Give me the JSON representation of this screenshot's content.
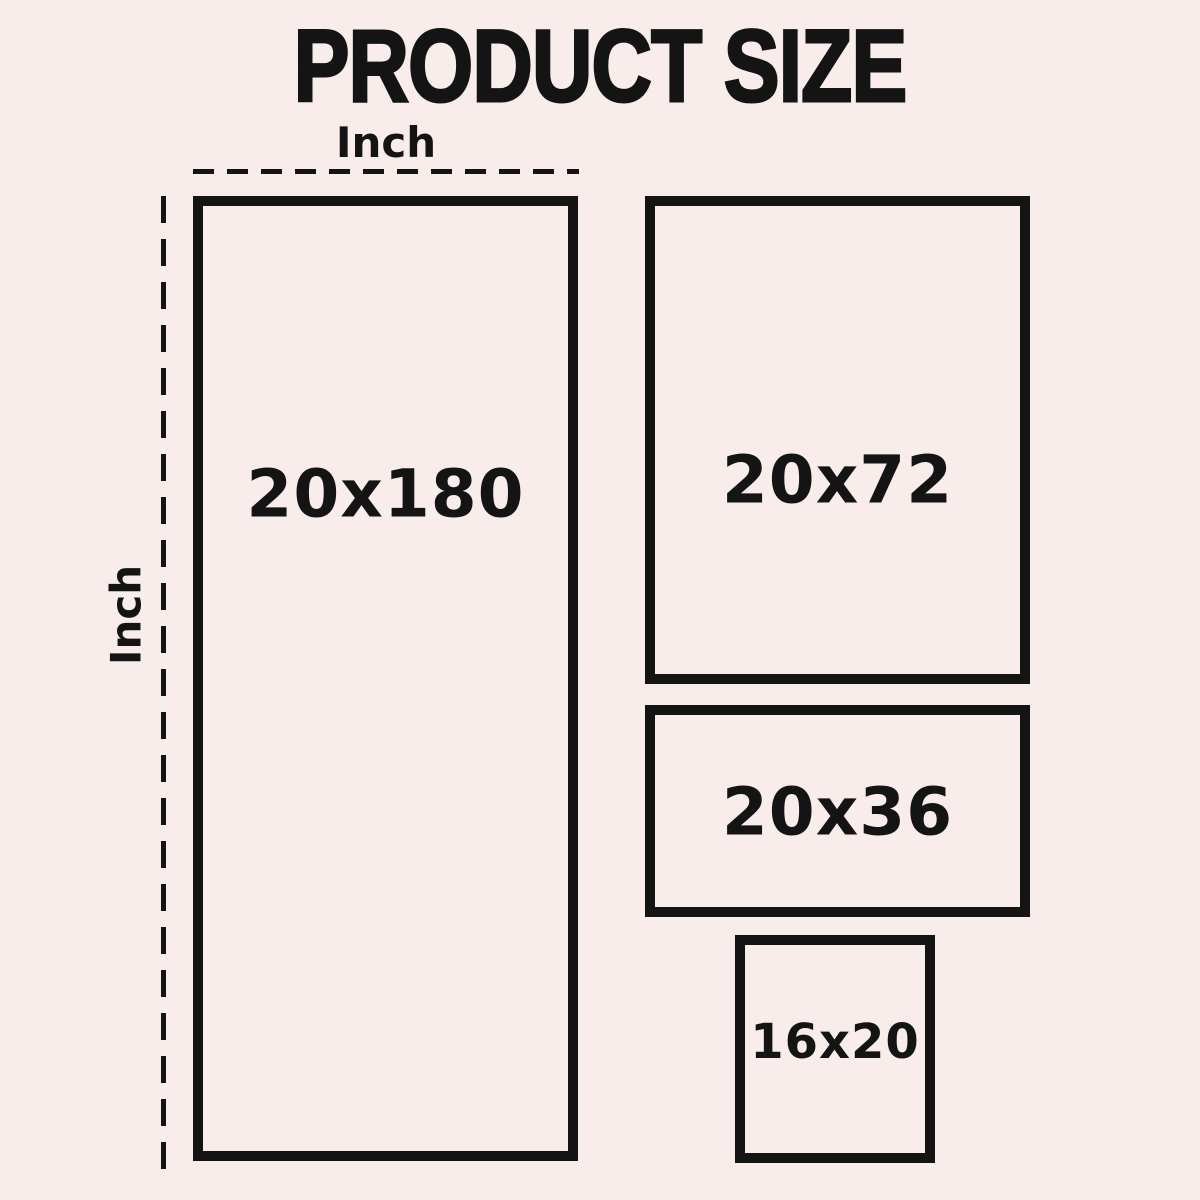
{
  "title": "PRODUCT SIZE",
  "ruler": {
    "top_unit": "Inch",
    "left_unit": "Inch"
  },
  "boxes": [
    {
      "label": "20x180"
    },
    {
      "label": "20x72"
    },
    {
      "label": "20x36"
    },
    {
      "label": "16x20"
    }
  ],
  "colors": {
    "background": "#f8edeb",
    "ink": "#141414"
  }
}
